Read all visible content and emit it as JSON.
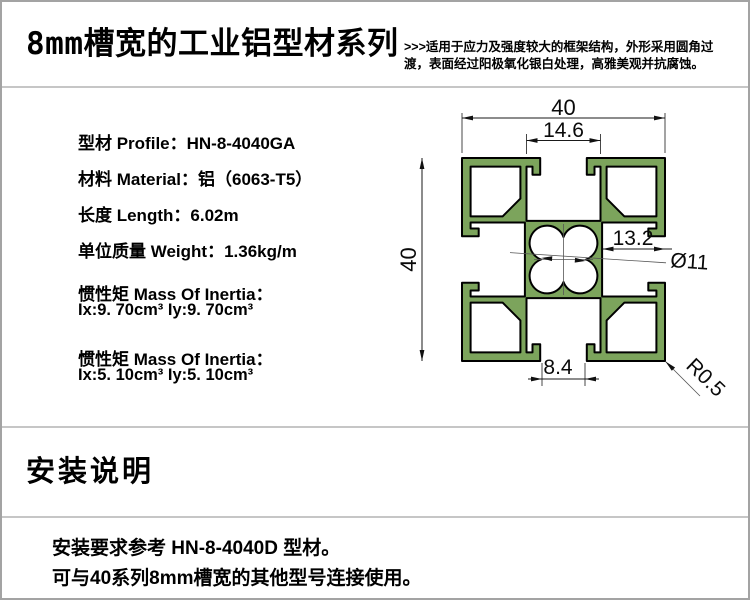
{
  "page": {
    "background": "#ffffff",
    "border_color": "#a3a3a3",
    "divider_color": "#c6c6c6"
  },
  "header": {
    "title_prefix": "8mm",
    "title_main": "槽宽的工业铝型材系列",
    "description_line1": ">>>适用于应力及强度较大的框架结构，外形采用圆角过",
    "description_line2": "渡，表面经过阳极氧化银白处理，高雅美观并抗腐蚀。"
  },
  "specs": {
    "rows": [
      {
        "label": "型材 Profile：",
        "value": "HN-8-4040GA"
      },
      {
        "label": "材料 Material：",
        "value": "铝（6063-T5）"
      },
      {
        "label": "长度 Length：",
        "value": "6.02m"
      },
      {
        "label": "单位质量 Weight：",
        "value": "1.36kg/m"
      }
    ],
    "inertia": [
      {
        "label": "惯性矩  Mass Of Inertia：",
        "value": "Ix:9. 70cm³  Iy:9. 70cm³"
      },
      {
        "label": "惯性矩  Mass Of Inertia：",
        "value": "Ix:5. 10cm³  Iy:5. 10cm³"
      }
    ]
  },
  "drawing": {
    "profile_fill": "#7CA45C",
    "dims": {
      "top_width": "40",
      "top_slot_width": "14.6",
      "left_height": "40",
      "side_depth": "13.2",
      "center_bore": "Ø11",
      "bottom_slot_opening": "8.4",
      "corner_radius": "R0.5"
    }
  },
  "install": {
    "heading": "安装说明",
    "note_line1": "安装要求参考 HN-8-4040D 型材。",
    "note_line2": "可与40系列8mm槽宽的其他型号连接使用。"
  }
}
